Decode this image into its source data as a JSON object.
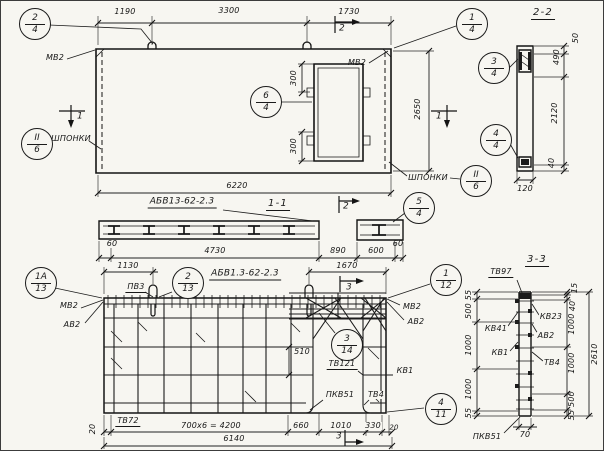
{
  "drawing": {
    "views": {
      "elevation": {
        "dims": {
          "top_left": "1190",
          "top_mid": "3300",
          "top_right": "1730",
          "overall_width": "6220",
          "height": "2650",
          "opening_offset_top": "300",
          "opening_offset_bottom": "300"
        },
        "labels": {
          "anchor_top_left": "МВ2",
          "anchor_top_right": "МВ2",
          "keys_left": "ШПОНКИ",
          "keys_right": "ШПОНКИ"
        },
        "markers": {
          "cut1_left": "1",
          "cut1_right": "1",
          "cut2_top": "2"
        }
      },
      "section_2_2": {
        "title": "2-2",
        "dims": {
          "d50": "50",
          "d490": "490",
          "d2120": "2120",
          "d40": "40",
          "d120": "120"
        }
      },
      "section_1_1": {
        "title": "1-1",
        "mark": "АБВ13-62-2.3",
        "marker_cut2": "2",
        "dims": {
          "d60_left": "60",
          "d4730": "4730",
          "d890": "890",
          "d600": "600",
          "d60_right": "60"
        }
      },
      "plan": {
        "mark": "АБВ1.3-62-2.3",
        "dims": {
          "d1130": "1130",
          "d1670": "1670",
          "d510": "510",
          "d20_left": "20",
          "d700": "700х6 = 4200",
          "d660": "660",
          "d1010": "1010",
          "d330": "330",
          "d20_right": "20",
          "d6140": "6140"
        },
        "labels": {
          "pv3": "ПВ3",
          "mv2_left": "МВ2",
          "av2_left": "АВ2",
          "mv2_right": "МВ2",
          "av2_right": "АВ2",
          "kv1": "КВ1",
          "tv121": "ТВ121",
          "pkv51": "ПКВ51",
          "tv4": "ТВ4",
          "tv72": "ТВ72"
        },
        "markers": {
          "cut3_top": "3",
          "cut3_bottom": "3"
        }
      },
      "section_3_3": {
        "title": "3-3",
        "labels": {
          "tv97": "ТВ97",
          "kv41": "КВ41",
          "kv23": "КВ23",
          "av2": "АВ2",
          "kv1": "КВ1",
          "tv4": "ТВ4",
          "pkv51": "ПКВ51"
        },
        "dims": {
          "left": [
            "55",
            "500",
            "1000",
            "1000",
            "55"
          ],
          "right": [
            "15",
            "40",
            "1000",
            "1000",
            "500",
            "55"
          ],
          "overall": "2610",
          "width": "70"
        }
      }
    },
    "callouts": {
      "c2_4": {
        "top": "2",
        "bottom": "4"
      },
      "c1_4": {
        "top": "1",
        "bottom": "4"
      },
      "c3_4": {
        "top": "3",
        "bottom": "4"
      },
      "c4_4": {
        "top": "4",
        "bottom": "4"
      },
      "c6_4": {
        "top": "6",
        "bottom": "4"
      },
      "c5_4": {
        "top": "5",
        "bottom": "4"
      },
      "cII_6_left": {
        "top": "II",
        "bottom": "6"
      },
      "cII_6_right": {
        "top": "II",
        "bottom": "6"
      },
      "c1a_13": {
        "top": "1А",
        "bottom": "13"
      },
      "c2_13": {
        "top": "2",
        "bottom": "13"
      },
      "c1_12": {
        "top": "1",
        "bottom": "12"
      },
      "c3_14": {
        "top": "3",
        "bottom": "14"
      },
      "c4_11": {
        "top": "4",
        "bottom": "11"
      }
    }
  }
}
